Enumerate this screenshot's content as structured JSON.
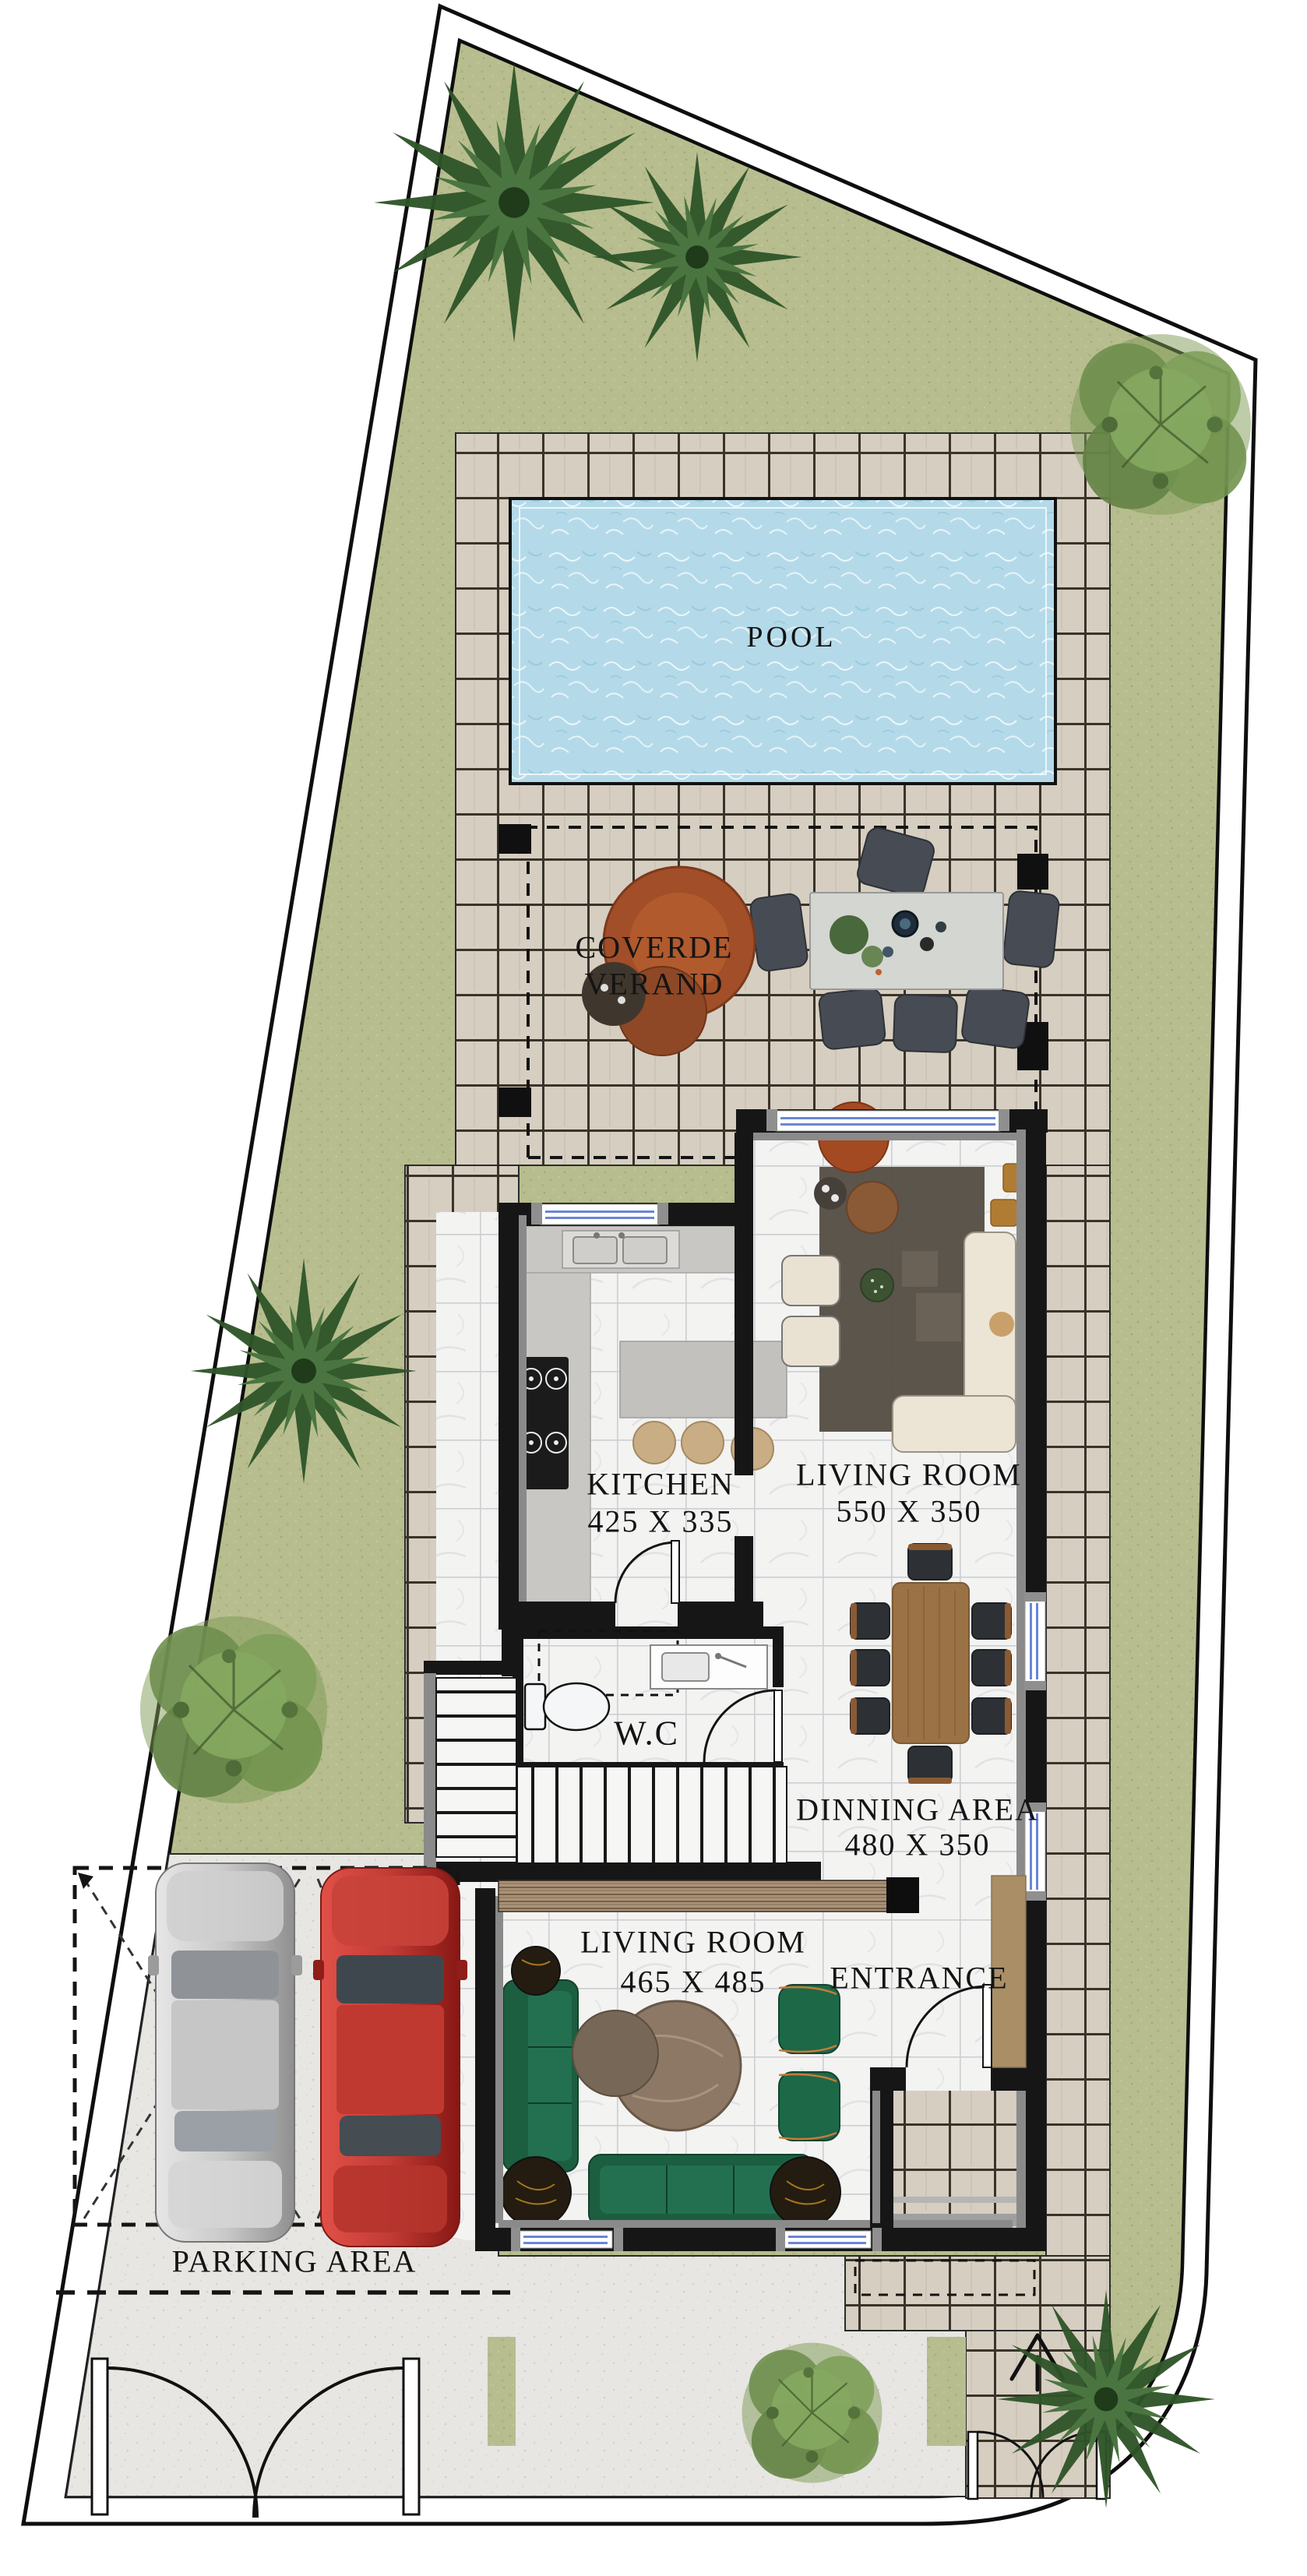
{
  "plan": {
    "type": "residential villa ground-floor architectural plan, top view",
    "labels": {
      "pool": "POOL",
      "veranda_line1": "COVERDE",
      "veranda_line2": "VERAND",
      "kitchen_name": "KITCHEN",
      "kitchen_dim": "425 X 335",
      "living_upper_name": "LIVING ROOM",
      "living_upper_dim": "550 X 350",
      "wc_name": "W.C",
      "dining_name": "DINNING AREA",
      "dining_dim": "480 X 350",
      "living_lower_name": "LIVING ROOM",
      "living_lower_dim": "465 X 485",
      "entrance_name": "ENTRANCE",
      "parking_name": "PARKING AREA"
    },
    "rooms": [
      {
        "name": "Pool",
        "label": "POOL",
        "dimensions": ""
      },
      {
        "name": "Covered veranda",
        "label": "COVERDE VERAND",
        "dimensions": ""
      },
      {
        "name": "Kitchen",
        "label": "KITCHEN",
        "dimensions": "425 X 335"
      },
      {
        "name": "Living room upper",
        "label": "LIVING ROOM",
        "dimensions": "550 X 350"
      },
      {
        "name": "W.C",
        "label": "W.C",
        "dimensions": ""
      },
      {
        "name": "Dining area",
        "label": "DINNING AREA",
        "dimensions": "480 X 350"
      },
      {
        "name": "Living room lower",
        "label": "LIVING ROOM",
        "dimensions": "465 X 485"
      },
      {
        "name": "Entrance",
        "label": "ENTRANCE",
        "dimensions": ""
      },
      {
        "name": "Parking area",
        "label": "PARKING AREA",
        "dimensions": ""
      }
    ],
    "colors": {
      "grass": "#b7bd8e",
      "deck_tile": "#d6cec0",
      "tile_joint": "#3a332a",
      "pool_water": "#b4dae9",
      "interior_floor": "#f3f3f2",
      "wall": "#161616",
      "wall_liner": "#8a8a8a",
      "concrete": "#e7e6e2",
      "sofa_green": "#1c5e40",
      "sofa_cream": "#e9e2d2",
      "pouf_rust": "#a24e28",
      "car_red": "#b02a24",
      "car_gray": "#adadad",
      "dining_wood": "#9a7245",
      "window_glass": "#6a85d6"
    },
    "objects": {
      "trees": [
        "palm-tree",
        "palm-tree",
        "leafy-tree",
        "palm-tree",
        "leafy-tree",
        "leafy-tree",
        "palm-tree"
      ],
      "cars": [
        "gray-car",
        "red-car"
      ],
      "fixtures": [
        "outdoor-dining-set",
        "round-lounge-pouf",
        "kitchen-counter-sink",
        "cooktop",
        "kitchen-island-stools",
        "cream-sofa-set",
        "rug",
        "dining-table-8-chairs",
        "toilet",
        "wash-basin",
        "staircase",
        "media-console",
        "green-sofa-set",
        "round-coffee-tables",
        "entrance-console",
        "double-garage-gate",
        "pedestrian-gate",
        "entry-arrow"
      ]
    }
  }
}
